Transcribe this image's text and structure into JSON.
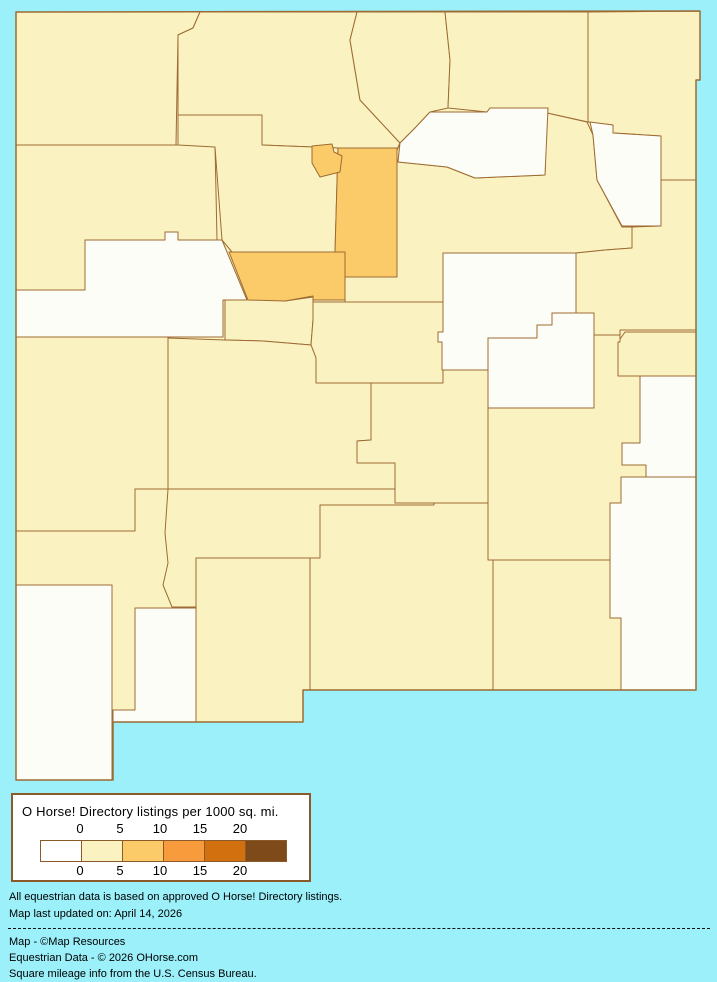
{
  "page": {
    "background": "#9BF0FA"
  },
  "map": {
    "border_color": "#9D6B33",
    "state_outline": "M16,12 L700,11 L700,80 L696,80 L696,690 L303,690 L303,722 L113,722 L113,780 L16,780 Z",
    "fills": {
      "v0": "#FDFDF7",
      "v0_5": "#FAF3C1",
      "v5_10": "#FBCB69"
    },
    "counties": [
      {
        "id": "san-juan",
        "name": "San Juan",
        "bucket": "v0_5",
        "path": "M16,12 L200,12 L193,28 L178,35 L176,145 L16,145 Z"
      },
      {
        "id": "rio-arriba",
        "name": "Rio Arriba",
        "bucket": "v0_5",
        "path": "M200,12 L357,12 L350,40 L355,70 L360,100 L400,143 L397,150 L338,148 L262,145 L262,115 L178,115 L178,35 L193,28 Z"
      },
      {
        "id": "taos",
        "name": "Taos",
        "bucket": "v0_5",
        "path": "M357,12 L445,12 L450,60 L448,108 L430,112 L415,128 L400,143 L360,100 L355,70 L350,40 Z"
      },
      {
        "id": "colfax",
        "name": "Colfax",
        "bucket": "v0_5",
        "path": "M445,12 L588,12 L588,122 L547,113 L548,108 L490,108 L487,112 L448,108 L450,60 Z"
      },
      {
        "id": "union",
        "name": "Union",
        "bucket": "v0_5",
        "path": "M588,12 L700,11 L700,80 L696,80 L696,180 L661,180 L661,136 L613,133 L613,125 L588,122 Z"
      },
      {
        "id": "mckinley",
        "name": "McKinley",
        "bucket": "v0_5",
        "path": "M16,145 L215,145 L217,240 L178,240 L178,232 L165,232 L165,240 L85,240 L85,290 L16,290 Z"
      },
      {
        "id": "sandoval",
        "name": "Sandoval",
        "bucket": "v0_5",
        "path": "M178,115 L262,115 L262,145 L338,148 L335,252 L232,252 L222,240 L215,147 L178,145 Z"
      },
      {
        "id": "san-miguel",
        "name": "San Miguel",
        "bucket": "v0_5",
        "path": "M400,143 L398,162 L447,167 L475,178 L545,175 L547,113 L587,122 L593,135 L597,180 L622,227 L632,227 L632,248 L605,250 L576,253 L443,253 L443,302 L345,302 L345,277 L397,277 L397,150 Z"
      },
      {
        "id": "quay",
        "name": "Quay",
        "bucket": "v0_5",
        "path": "M661,180 L696,180 L696,330 L620,330 L620,335 L576,335 L576,253 L605,250 L632,248 L632,227 L661,226 Z"
      },
      {
        "id": "valencia",
        "name": "Valencia",
        "bucket": "v0_5",
        "path": "M225,292 L240,296 L285,301 L313,297 L313,320 L311,345 L263,341 L225,340 Z"
      },
      {
        "id": "torrance",
        "name": "Torrance",
        "bucket": "v0_5",
        "path": "M313,302 L443,302 L443,383 L316,383 L316,358 L311,345 L313,320 Z"
      },
      {
        "id": "curry",
        "name": "Curry",
        "bucket": "v0_5",
        "path": "M618,376 L618,342 L625,332 L696,332 L696,376 Z"
      },
      {
        "id": "catron",
        "name": "Catron",
        "bucket": "v0_5",
        "path": "M16,337 L168,337 L168,489 L135,489 L135,531 L16,531 Z"
      },
      {
        "id": "socorro",
        "name": "Socorro",
        "bucket": "v0_5",
        "path": "M168,338 L225,340 L263,341 L311,345 L316,358 L316,383 L371,383 L371,440 L357,441 L357,463 L395,463 L395,489 L168,489 Z"
      },
      {
        "id": "lincoln",
        "name": "Lincoln",
        "bucket": "v0_5",
        "path": "M371,383 L443,383 L443,370 L488,370 L488,503 L395,503 L395,463 L357,463 L357,441 L371,440 Z"
      },
      {
        "id": "chaves",
        "name": "Chaves",
        "bucket": "v0_5",
        "path": "M594,335 L620,335 L620,342 L618,342 L618,376 L640,376 L640,443 L622,443 L622,465 L646,465 L646,477 L621,477 L621,503 L610,503 L610,560 L488,560 L488,408 L594,408 Z"
      },
      {
        "id": "sierra",
        "name": "Sierra",
        "bucket": "v0_5",
        "path": "M135,489 L395,489 L395,503 L434,503 L434,505 L320,505 L320,558 L196,558 L196,607 L172,607 L160,585 L163,563 L152,533 L135,531 Z"
      },
      {
        "id": "otero",
        "name": "Otero",
        "bucket": "v0_5",
        "path": "M320,505 L434,505 L434,503 L488,503 L488,560 L493,560 L493,690 L310,690 L310,558 L320,558 Z"
      },
      {
        "id": "dona-ana",
        "name": "Doña Ana",
        "bucket": "v0_5",
        "path": "M196,558 L310,558 L310,690 L303,690 L303,722 L196,722 Z"
      },
      {
        "id": "grant",
        "name": "Grant",
        "bucket": "v0_5",
        "path": "M16,531 L135,531 L135,489 L168,489 L165,533 L168,563 L163,585 L172,607 L196,607 L196,608 L135,608 L135,710 L112,710 L112,585 L16,585 Z"
      },
      {
        "id": "eddy",
        "name": "Eddy",
        "bucket": "v0_5",
        "path": "M493,560 L610,560 L610,618 L621,618 L621,690 L493,690 Z"
      },
      {
        "id": "mora",
        "name": "Mora",
        "bucket": "v0",
        "path": "M400,143 L415,128 L430,112 L487,112 L490,108 L548,108 L545,175 L475,178 L447,167 L398,162 Z"
      },
      {
        "id": "harding",
        "name": "Harding",
        "bucket": "v0",
        "path": "M590,122 L613,125 L613,133 L661,136 L661,226 L622,226 L597,180 L593,135 Z"
      },
      {
        "id": "cibola",
        "name": "Cibola",
        "bucket": "v0",
        "path": "M85,240 L165,240 L165,232 L178,232 L178,240 L222,240 L247,300 L223,300 L223,337 L16,337 L16,290 L85,290 Z"
      },
      {
        "id": "guadalupe",
        "name": "Guadalupe",
        "bucket": "v0",
        "path": "M443,253 L576,253 L576,313 L552,313 L552,325 L537,325 L537,338 L488,338 L488,370 L442,370 L442,342 L438,342 L438,332 L443,332 Z"
      },
      {
        "id": "de-baca",
        "name": "De Baca",
        "bucket": "v0",
        "path": "M488,338 L537,338 L537,325 L552,325 L552,313 L594,313 L594,408 L488,408 Z"
      },
      {
        "id": "roosevelt",
        "name": "Roosevelt",
        "bucket": "v0",
        "path": "M640,376 L696,376 L696,477 L646,477 L646,465 L622,465 L622,443 L640,443 Z"
      },
      {
        "id": "lea",
        "name": "Lea",
        "bucket": "v0",
        "path": "M621,477 L696,477 L696,690 L621,690 L621,618 L610,618 L610,503 L621,503 Z"
      },
      {
        "id": "luna",
        "name": "Luna",
        "bucket": "v0",
        "path": "M135,608 L196,608 L196,722 L113,722 L113,710 L135,710 Z"
      },
      {
        "id": "hidalgo",
        "name": "Hidalgo",
        "bucket": "v0",
        "path": "M16,585 L112,585 L112,780 L16,780 Z"
      },
      {
        "id": "santa-fe",
        "name": "Santa Fe",
        "bucket": "v5_10",
        "path": "M338,148 L397,148 L397,277 L345,277 L345,252 L335,252 Z"
      },
      {
        "id": "bernalillo",
        "name": "Bernalillo",
        "bucket": "v5_10",
        "path": "M229,252 L345,252 L345,300 L313,300 L313,296 L285,301 L248,300 Z"
      },
      {
        "id": "los-alamos",
        "name": "Los Alamos",
        "bucket": "v5_10",
        "path": "M312,146 L332,144 L334,152 L342,156 L340,172 L320,177 L312,163 Z"
      }
    ]
  },
  "chart_data": {
    "type": "heatmap",
    "title": "O Horse! Directory listings per 1000 sq. mi.",
    "legend_ticks": [
      0,
      5,
      10,
      15,
      20
    ],
    "buckets": [
      "0",
      "0-5",
      "5-10",
      "10-15",
      "15-20",
      "20+"
    ],
    "bucket_colors": [
      "#FFFFFF",
      "#FAF3C1",
      "#FBCB69",
      "#F89B3D",
      "#D2700F",
      "#7E4A1A"
    ],
    "regions_v0": [
      "Mora",
      "Harding",
      "Cibola",
      "Guadalupe",
      "De Baca",
      "Roosevelt",
      "Lea",
      "Luna",
      "Hidalgo"
    ],
    "regions_v0_5": [
      "San Juan",
      "Rio Arriba",
      "Taos",
      "Colfax",
      "Union",
      "McKinley",
      "Sandoval",
      "San Miguel",
      "Quay",
      "Valencia",
      "Torrance",
      "Curry",
      "Catron",
      "Socorro",
      "Lincoln",
      "Chaves",
      "Sierra",
      "Otero",
      "Doña Ana",
      "Grant",
      "Eddy"
    ],
    "regions_v5_10": [
      "Santa Fe",
      "Bernalillo",
      "Los Alamos"
    ]
  },
  "legend": {
    "title": "O Horse! Directory listings per 1000 sq. mi.",
    "ticks": [
      "0",
      "5",
      "10",
      "15",
      "20"
    ],
    "swatches": [
      "#FFFFFF",
      "#FAF3C1",
      "#FBCB69",
      "#F89B3D",
      "#D2700F",
      "#7E4A1A"
    ]
  },
  "notes": [
    "All equestrian data is based on approved O Horse! Directory listings.",
    "Map last updated on: April 14, 2026"
  ],
  "credits": [
    "Map - ©Map Resources",
    "Equestrian Data - © 2026 OHorse.com",
    "Square mileage info from the U.S. Census Bureau."
  ]
}
